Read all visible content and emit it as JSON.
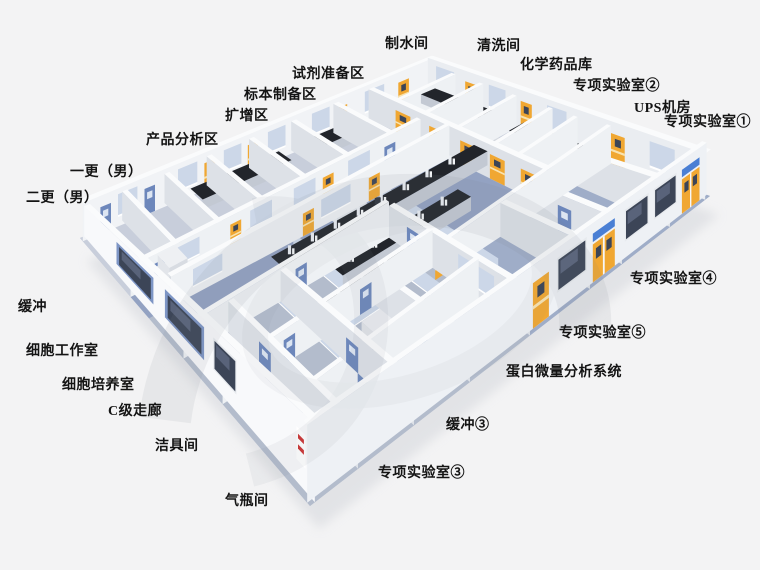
{
  "scene_labels_note": "annotation labels on a 3D laboratory floor-plan rendering",
  "labels": [
    {
      "id": "zhishuijian",
      "text": "制水间",
      "x": 385,
      "y": 38
    },
    {
      "id": "qingxijian",
      "text": "清洗间",
      "x": 477,
      "y": 40
    },
    {
      "id": "huaxueyaopinku",
      "text": "化学药品库",
      "x": 520,
      "y": 59
    },
    {
      "id": "zhuanxiang-2",
      "text": "专项实验室②",
      "x": 573,
      "y": 80
    },
    {
      "id": "ups-jifang",
      "text": "UPS机房",
      "x": 634,
      "y": 102
    },
    {
      "id": "zhuanxiang-1",
      "text": "专项实验室①",
      "x": 664,
      "y": 116
    },
    {
      "id": "shiji-zhunbeiqu",
      "text": "试剂准备区",
      "x": 292,
      "y": 68
    },
    {
      "id": "biaoben-zhibeiqu",
      "text": "标本制备区",
      "x": 244,
      "y": 89
    },
    {
      "id": "kuozengqu",
      "text": "扩增区",
      "x": 225,
      "y": 110
    },
    {
      "id": "chanpin-fenxiqu",
      "text": "产品分析区",
      "x": 146,
      "y": 134
    },
    {
      "id": "yigeng-nan",
      "text": "一更（男）",
      "x": 70,
      "y": 166
    },
    {
      "id": "ergeng-nan",
      "text": "二更（男）",
      "x": 26,
      "y": 192
    },
    {
      "id": "huanchong",
      "text": "缓冲",
      "x": 18,
      "y": 301
    },
    {
      "id": "xibao-gongzuoshi",
      "text": "细胞工作室",
      "x": 26,
      "y": 345
    },
    {
      "id": "xibao-peiyangshi",
      "text": "细胞培养室",
      "x": 62,
      "y": 379
    },
    {
      "id": "c-ji-zoulang",
      "text": "C级走廊",
      "x": 108,
      "y": 405
    },
    {
      "id": "jiejujian",
      "text": "洁具间",
      "x": 155,
      "y": 440
    },
    {
      "id": "qipingjian",
      "text": "气瓶间",
      "x": 225,
      "y": 495
    },
    {
      "id": "zhuanxiang-4",
      "text": "专项实验室④",
      "x": 630,
      "y": 273
    },
    {
      "id": "zhuanxiang-5",
      "text": "专项实验室⑤",
      "x": 559,
      "y": 327
    },
    {
      "id": "danbai-weiliang",
      "text": "蛋白微量分析系统",
      "x": 506,
      "y": 366
    },
    {
      "id": "huanchong-3",
      "text": "缓冲③",
      "x": 446,
      "y": 419
    },
    {
      "id": "zhuanxiang-3",
      "text": "专项实验室③",
      "x": 378,
      "y": 467
    }
  ],
  "colors": {
    "background": "#f3f3f4",
    "shadow": "#d7d9de",
    "label_text": "#141414",
    "floor_base": "#b7bfce",
    "floor_room": "#c8cedb",
    "floor_lab": "#93a2c2",
    "floor_lab2": "#9fadc8",
    "floor_block": "#b3bccc",
    "wall_top": "#fafbfc",
    "wall_face_light": "#eef1f4",
    "wall_face_shade": "#dde1e7",
    "wall_outer_left": "#f8f9fb",
    "wall_outer_right": "#eef1f5",
    "wall_inner_back": "#f1f3f6",
    "wall_inner_right": "#eaedf1",
    "bench_top": "#22252b",
    "bench_body": "#c3c9d3",
    "door_yellow": "#f0a732",
    "door_yellow_light": "#f8e3b0",
    "door_blue": "#6d87bb",
    "door_blue_light": "#dce5f2",
    "window_glass": "#3c4557",
    "window_glass_hi": "#59637a",
    "window_frame": "#e7eaee",
    "window_frame_blue": "#7d95c5",
    "glass_partition": "#ccd7e8",
    "sign_blue": "#4a7fd4",
    "sign_red": "#cc3333",
    "sign_white": "#ffffff",
    "equip_dark": "#3e444d",
    "equip_mid": "#4a5059",
    "equip_light": "#eef0f3",
    "watermark": "#7e858f"
  }
}
